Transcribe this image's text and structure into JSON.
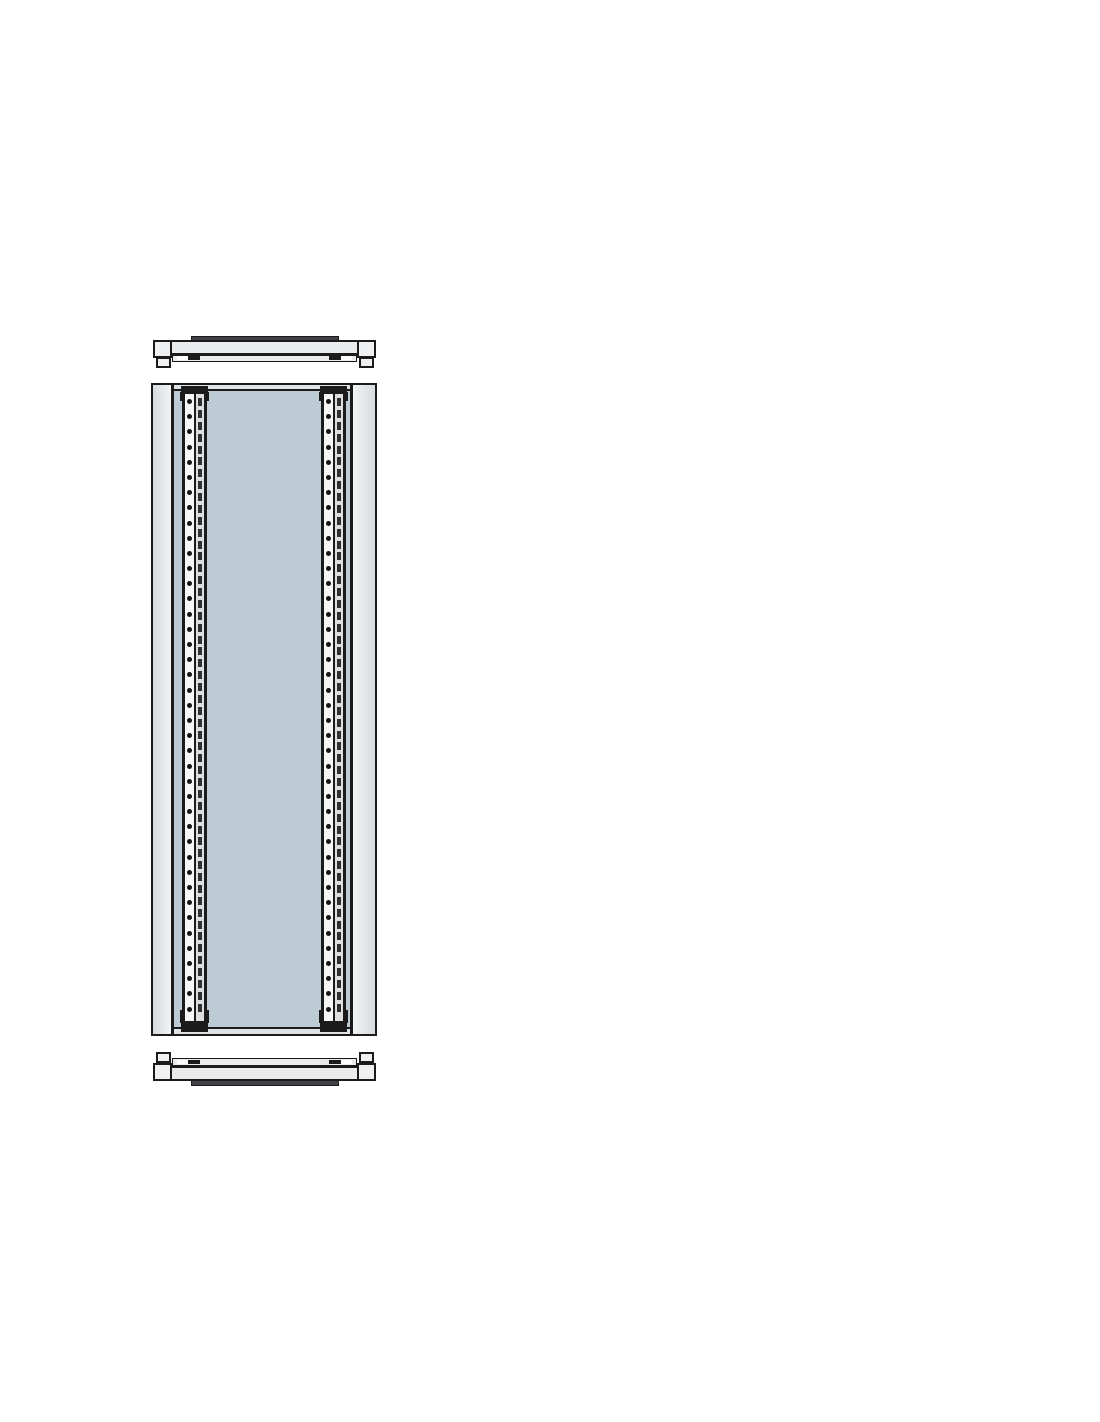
{
  "figure": {
    "kind": "technical-line-drawing",
    "subject": "enclosure-partition-panel-exploded-view",
    "colors": {
      "page_bg": "#ffffff",
      "line": "#1b1b1b",
      "bar_fill": "#e9ebec",
      "block_fill": "#eef0f1",
      "ridge_fill": "#3f4144",
      "panel_side_from": "#d7dbde",
      "panel_side_to": "#f2f4f5",
      "panel_face": "#bccbd4",
      "panel_edge_strip": "#e0e4e7",
      "rail_strip": "#f6f6f5",
      "rail_channel": "#dcdedf",
      "hole": "#141414",
      "slot": "#2e3032",
      "clip": "#1b1b1b",
      "notch": "#ffffff"
    },
    "parts": {
      "top_rail": {
        "label": "top cross rail"
      },
      "bottom_rail": {
        "label": "bottom cross rail"
      },
      "panel": {
        "label": "partition panel"
      },
      "uprights": {
        "label": "perforated mounting uprights",
        "count": 2,
        "holes_per_upright": 41,
        "slots_per_upright": 52
      }
    }
  }
}
